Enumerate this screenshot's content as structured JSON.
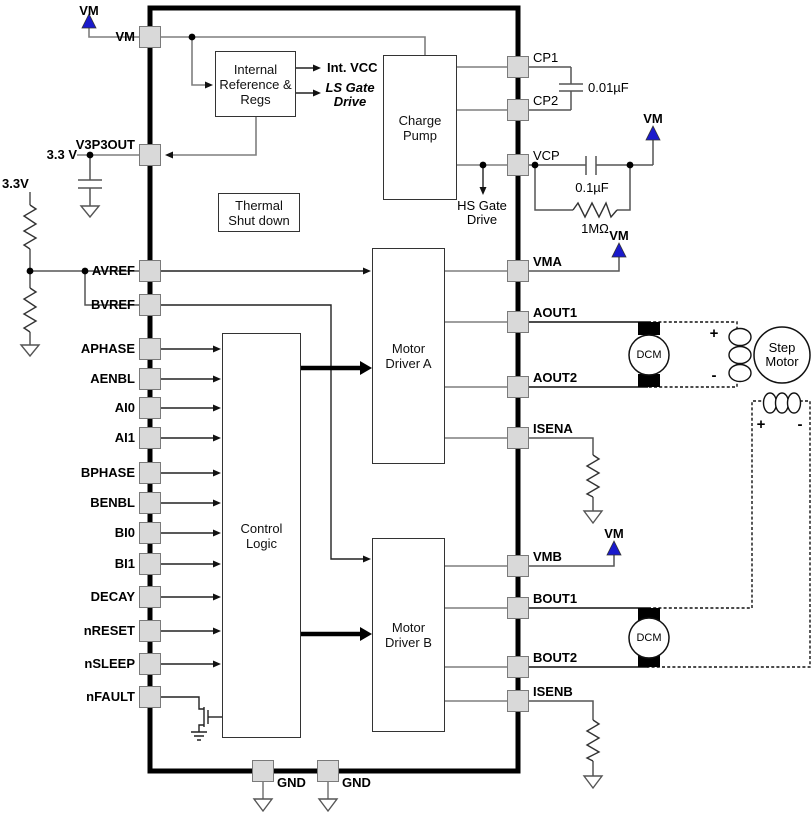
{
  "chip": {
    "pins_left": [
      "VM",
      "V3P3OUT",
      "AVREF",
      "BVREF",
      "APHASE",
      "AENBL",
      "AI0",
      "AI1",
      "BPHASE",
      "BENBL",
      "BI0",
      "BI1",
      "DECAY",
      "nRESET",
      "nSLEEP",
      "nFAULT"
    ],
    "pins_right": [
      "CP1",
      "CP2",
      "VCP",
      "VMA",
      "AOUT1",
      "AOUT2",
      "ISENA",
      "VMB",
      "BOUT1",
      "BOUT2",
      "ISENB"
    ],
    "pins_bottom": [
      "GND",
      "GND"
    ],
    "blocks": {
      "internal_reference": {
        "lines": [
          "Internal",
          "Reference &",
          "Regs"
        ]
      },
      "thermal": {
        "lines": [
          "Thermal",
          "Shut down"
        ]
      },
      "charge_pump": {
        "lines": [
          "Charge",
          "Pump"
        ]
      },
      "control_logic": {
        "lines": [
          "Control",
          "Logic"
        ]
      },
      "motor_driver_a": {
        "lines": [
          "Motor",
          "Driver A"
        ]
      },
      "motor_driver_b": {
        "lines": [
          "Motor",
          "Driver B"
        ]
      }
    },
    "internal_signals": {
      "int_vcc": "Int. VCC",
      "ls_gate_drive": {
        "lines": [
          "LS Gate",
          "Drive"
        ]
      },
      "hs_gate_drive": {
        "lines": [
          "HS Gate",
          "Drive"
        ]
      }
    }
  },
  "external": {
    "vm_label": "VM",
    "v33_supply": "3.3 V",
    "v33_divider": "3.3V",
    "cp_capacitor": "0.01µF",
    "vcp_capacitor": "0.1µF",
    "vcp_resistor": "1MΩ",
    "dcm": "DCM",
    "step_motor": {
      "lines": [
        "Step",
        "Motor"
      ]
    },
    "plus": "+",
    "minus": "-"
  },
  "colors": {
    "power_arrow_blue": "#1a1acc",
    "pin_fill": "#d9d9d9",
    "chip_border": "#000000"
  }
}
